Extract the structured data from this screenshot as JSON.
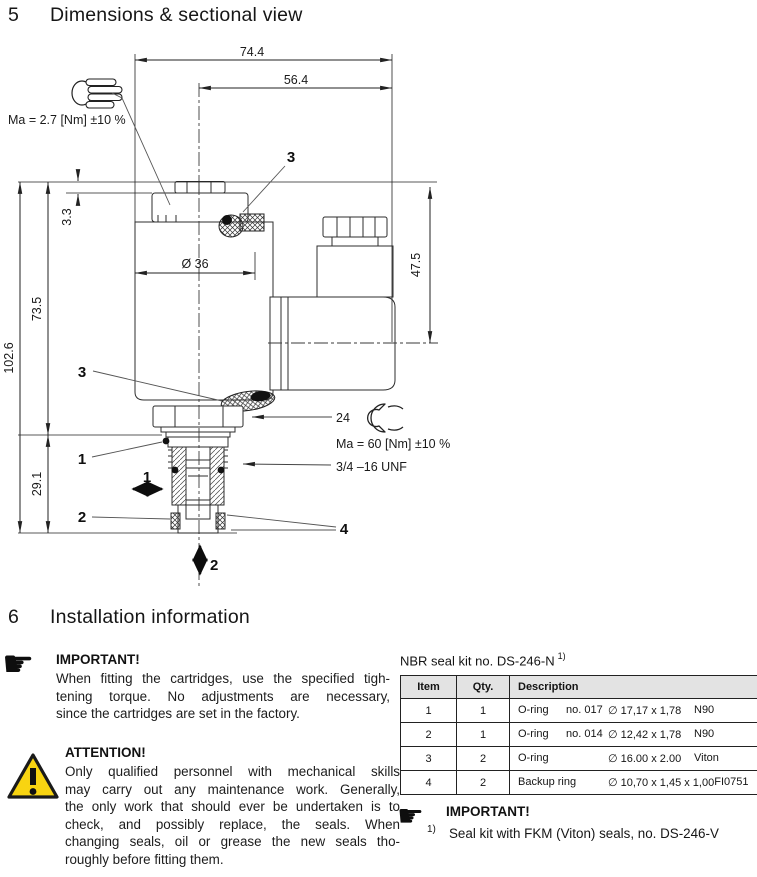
{
  "section5": {
    "number": "5",
    "title": "Dimensions & sectional view"
  },
  "section6": {
    "number": "6",
    "title": "Installation information"
  },
  "drawing": {
    "dims": {
      "total_width": "74.4",
      "upper_width": "56.4",
      "cap_height": "3.3",
      "coil_diameter": "Ø 36",
      "connector_height": "47.5",
      "coil_height": "73.5",
      "total_height": "102.6",
      "cartridge_height": "29.1",
      "hex_af": "24"
    },
    "labels": {
      "torque_hand": "Ma = 2.7 [Nm] ±10 %",
      "torque_nut": "Ma = 60 [Nm] ±10 %",
      "thread": "3/4 –16 UNF"
    },
    "callouts": {
      "c1": "1",
      "c2": "2",
      "c3_top": "3",
      "c3_side": "3",
      "c4": "4",
      "port1": "1",
      "port2": "2"
    }
  },
  "important_fitting": {
    "heading": "IMPORTANT!",
    "lines": [
      "When fitting the cartridges, use the specified tigh-",
      "tening torque. No adjustments are necessary,",
      "since the cartridges are set in the factory."
    ]
  },
  "attention": {
    "heading": "ATTENTION!",
    "lines": [
      "Only qualified personnel with mechanical skills",
      "may carry out any maintenance work. Generally,",
      "the only work that should ever be undertaken is to",
      "check, and possibly replace, the seals. When",
      "changing seals, oil or grease the new seals tho-",
      "roughly before fitting them."
    ]
  },
  "seal_kit": {
    "title": "NBR seal kit no. DS-246-N",
    "footnote_ref": "1)",
    "columns": {
      "item": "Item",
      "qty": "Qty.",
      "description": "Description"
    },
    "rows": [
      {
        "item": "1",
        "qty": "1",
        "name": "O-ring",
        "no": "no. 017",
        "size": "∅ 17,17 x 1,78",
        "material": "N90"
      },
      {
        "item": "2",
        "qty": "1",
        "name": "O-ring",
        "no": "no. 014",
        "size": "∅ 12,42 x 1,78",
        "material": "N90"
      },
      {
        "item": "3",
        "qty": "2",
        "name": "O-ring",
        "no": "",
        "size": "∅ 16.00 x 2.00",
        "material": "Viton"
      },
      {
        "item": "4",
        "qty": "2",
        "name": "Backup ring",
        "no": "",
        "size": "∅ 10,70 x 1,45 x 1,00",
        "material": "FI0751"
      }
    ]
  },
  "important_seal": {
    "heading": "IMPORTANT!",
    "footnote_marker": "1)",
    "text": "Seal kit with FKM (Viton) seals, no. DS-246-V"
  },
  "colors": {
    "warning_yellow": "#f8d411",
    "line": "#2d2d2d",
    "table_header_bg": "#e3e3e3"
  }
}
